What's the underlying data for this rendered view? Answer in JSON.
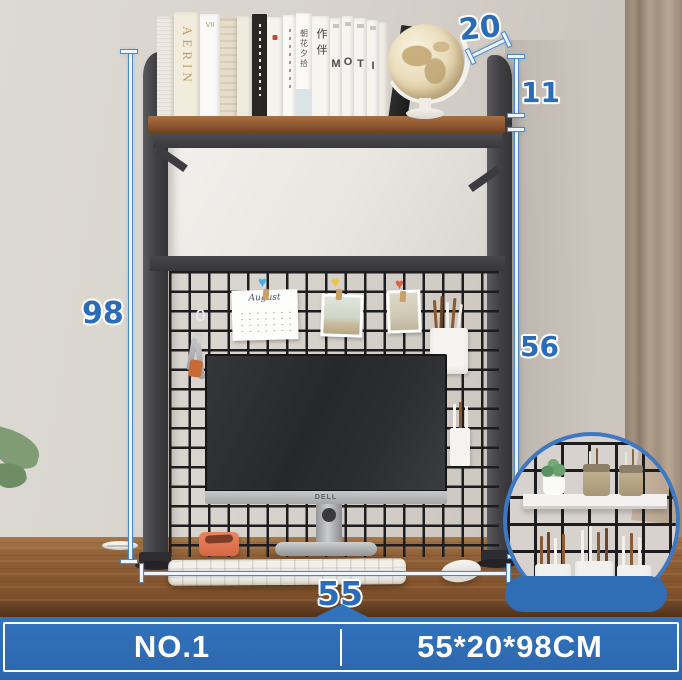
{
  "badge": {
    "model_label": "NO.1",
    "size_label": "55*20*98CM"
  },
  "dimensions": {
    "height": "98",
    "inner_height": "56",
    "depth": "20",
    "top_gap": "11",
    "width": "55",
    "unit": "CM"
  },
  "books": {
    "aerin": "AERIN",
    "vii": "VII",
    "zhao_hua_xi_shi": "朝花夕拾",
    "zuo_ban": "作伴",
    "moti": [
      "M",
      "O",
      "T",
      "I"
    ]
  },
  "monitor": {
    "brand": "DELL"
  },
  "board": {
    "calendar_title": "August"
  },
  "colors": {
    "accent_blue": "#2e6cb4",
    "dimension_text": "#2a6cb8",
    "heart_blue": "#3fb3e8",
    "heart_yellow": "#f0c53a",
    "heart_red": "#e0623d"
  }
}
